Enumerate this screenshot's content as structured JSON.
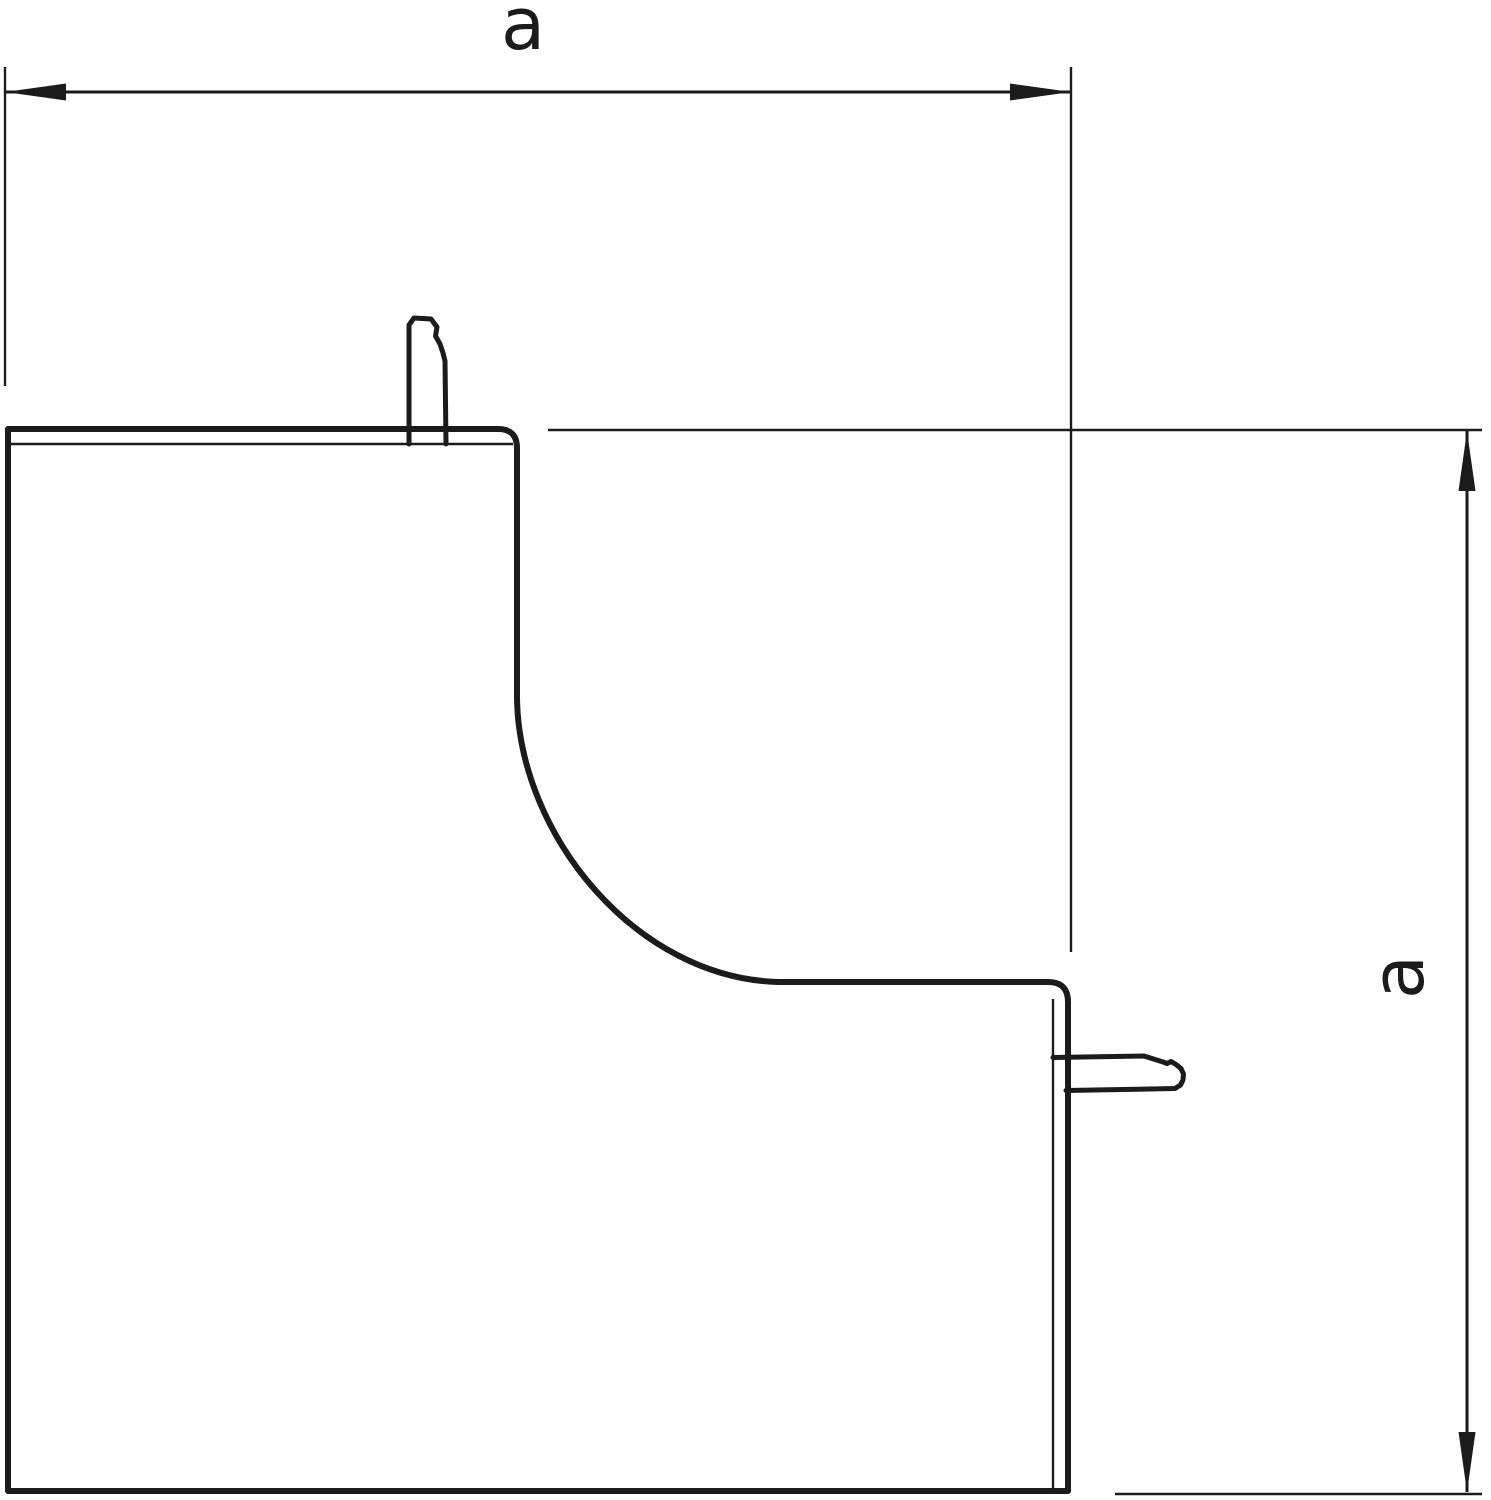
{
  "drawing": {
    "dimension_labels": {
      "width": "a",
      "height": "a"
    },
    "colors": {
      "line": "#1b1b1b",
      "background": "#ffffff"
    }
  }
}
